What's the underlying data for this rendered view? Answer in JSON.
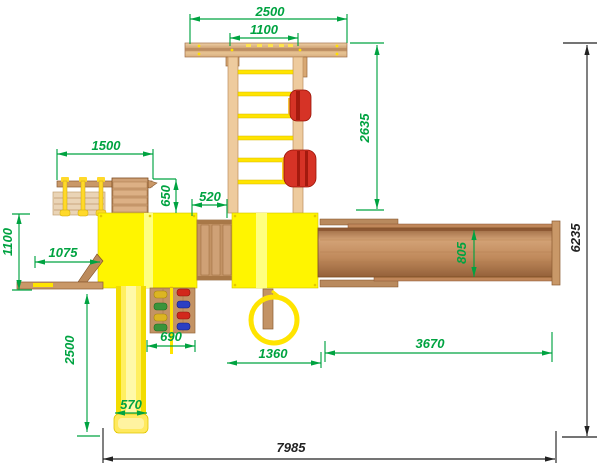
{
  "drawing": {
    "description": "Top view technical drawing of a wooden playground complex with towers, ladder, slide, climbing wall and swing beam",
    "units_note": ""
  },
  "dims": {
    "top_beam": {
      "value": "2500"
    },
    "ladder_width": {
      "value": "1100"
    },
    "ladder_length": {
      "value": "2635"
    },
    "left_gym": {
      "value": "1500"
    },
    "gym_depth": {
      "value": "650"
    },
    "bridge": {
      "value": "520"
    },
    "board_depth": {
      "value": "1100"
    },
    "board_length": {
      "value": "1075"
    },
    "slide_length": {
      "value": "2500"
    },
    "climb_wall": {
      "value": "690"
    },
    "slide_width": {
      "value": "570"
    },
    "ring_offset": {
      "value": "1360"
    },
    "swing_beam": {
      "value": "3670"
    },
    "beam_width": {
      "value": "805"
    },
    "overall_depth": {
      "value": "6235"
    },
    "overall_width": {
      "value": "7985"
    }
  },
  "colors": {
    "dimension_green": "#00A341",
    "dimension_black": "#222222",
    "platform_yellow": "#FFF500",
    "slide_yellow": "#FFEF60",
    "rung_yellow": "#FFE400",
    "wood_light": "#EECB9E",
    "wood_mid": "#C39365",
    "wood_dark": "#8A5C32",
    "seat_red": "#D63326",
    "hold_yellow": "#DCB522",
    "hold_green": "#3B943B",
    "hold_red": "#D2281C",
    "hold_blue": "#2B3FC4"
  }
}
